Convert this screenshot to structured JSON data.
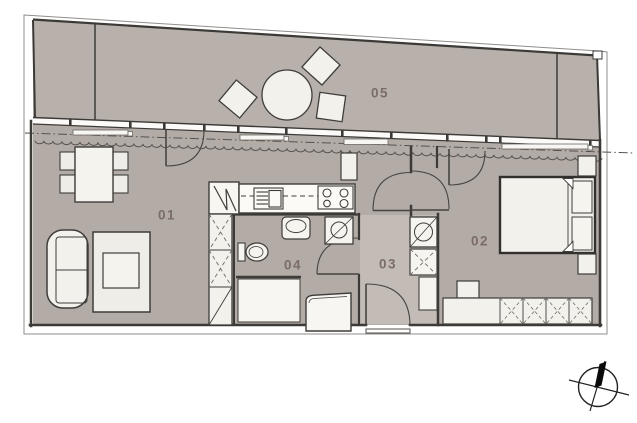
{
  "rooms": [
    {
      "label": "01"
    },
    {
      "label": "02"
    },
    {
      "label": "03"
    },
    {
      "label": "04"
    },
    {
      "label": "05"
    }
  ],
  "icons": {
    "compass": "north-compass-icon"
  },
  "colors": {
    "floor": "#b3aba6",
    "balcony_floor": "#b8b1ab",
    "hall_floor": "#c3bcb6",
    "furniture": "#f2f1ec",
    "wall": "#3c3a37",
    "outline": "#908e8a",
    "label": "#7b6d66"
  }
}
